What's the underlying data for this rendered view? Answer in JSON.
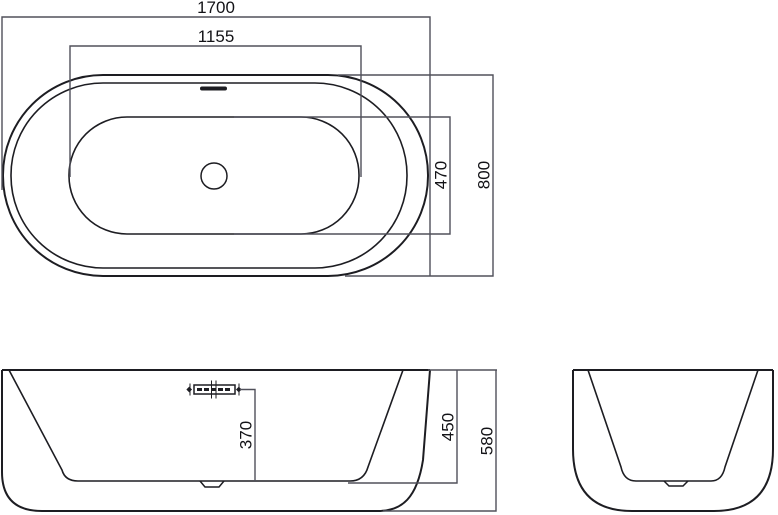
{
  "colors": {
    "background": "#ffffff",
    "outline": "#1d1d22",
    "dimension": "#50505a",
    "label": "#131317"
  },
  "top_view": {
    "overall_length": "1700",
    "basin_length": "1155",
    "basin_width": "470",
    "overall_width": "800"
  },
  "front_view": {
    "overflow_to_floor": "370",
    "rim_to_floor": "450",
    "overall_height": "580"
  }
}
